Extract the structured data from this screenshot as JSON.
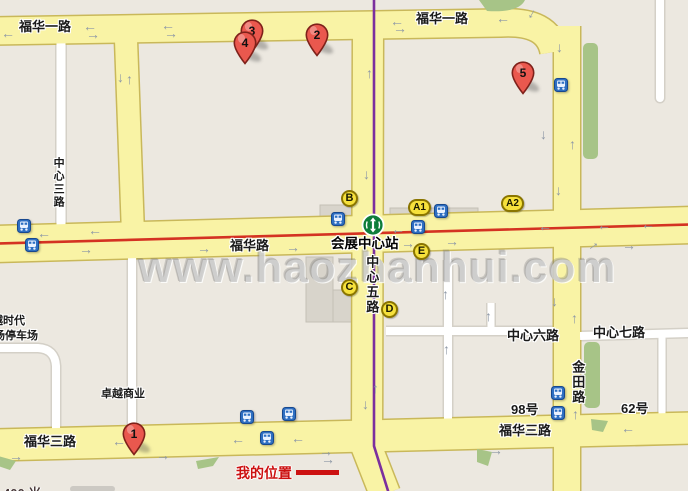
{
  "map": {
    "watermark": "www.haozhanhui.com",
    "scale_text": "400 米",
    "my_location": {
      "label": "我的位置"
    },
    "metro_station": {
      "name": "会展中心站"
    },
    "roads": {
      "fuhua1_left": "福华一路",
      "fuhua1_right": "福华一路",
      "fuhua": "福华路",
      "fuhua3_left": "福华三路",
      "fuhua3_right": "福华三路",
      "zhongxin3": "中心三路",
      "zhongxin5": "中心五路",
      "zhongxin6": "中心六路",
      "zhongxin7": "中心七路",
      "jintian": "金田路",
      "no_98": "98号",
      "no_62": "62号"
    },
    "places": {
      "zhuoyue_shangye": "卓越商业",
      "yue_shidai": "越时代",
      "chang_tingchechang": "场停车场"
    },
    "pins": [
      {
        "number": "1"
      },
      {
        "number": "2"
      },
      {
        "number": "3"
      },
      {
        "number": "4"
      },
      {
        "number": "5"
      }
    ],
    "exit_badges": [
      {
        "label": "B"
      },
      {
        "label": "A1"
      },
      {
        "label": "A2"
      },
      {
        "label": "C"
      },
      {
        "label": "D"
      },
      {
        "label": "E"
      }
    ],
    "icons": {
      "arrow_left": "←",
      "arrow_right": "→",
      "arrow_up": "↑",
      "arrow_down": "↓"
    },
    "colors": {
      "road_fill": "#f9f3a5",
      "road_casing": "#c9b85a",
      "metro_line_purple": "#7b2f9e",
      "line_red": "#d43222",
      "pin_red": "#ea584e",
      "bus_blue": "#2e6fc2",
      "badge_yellow": "#f6e13c",
      "green_area": "#a7c487",
      "my_location_red": "#cc1111"
    }
  }
}
